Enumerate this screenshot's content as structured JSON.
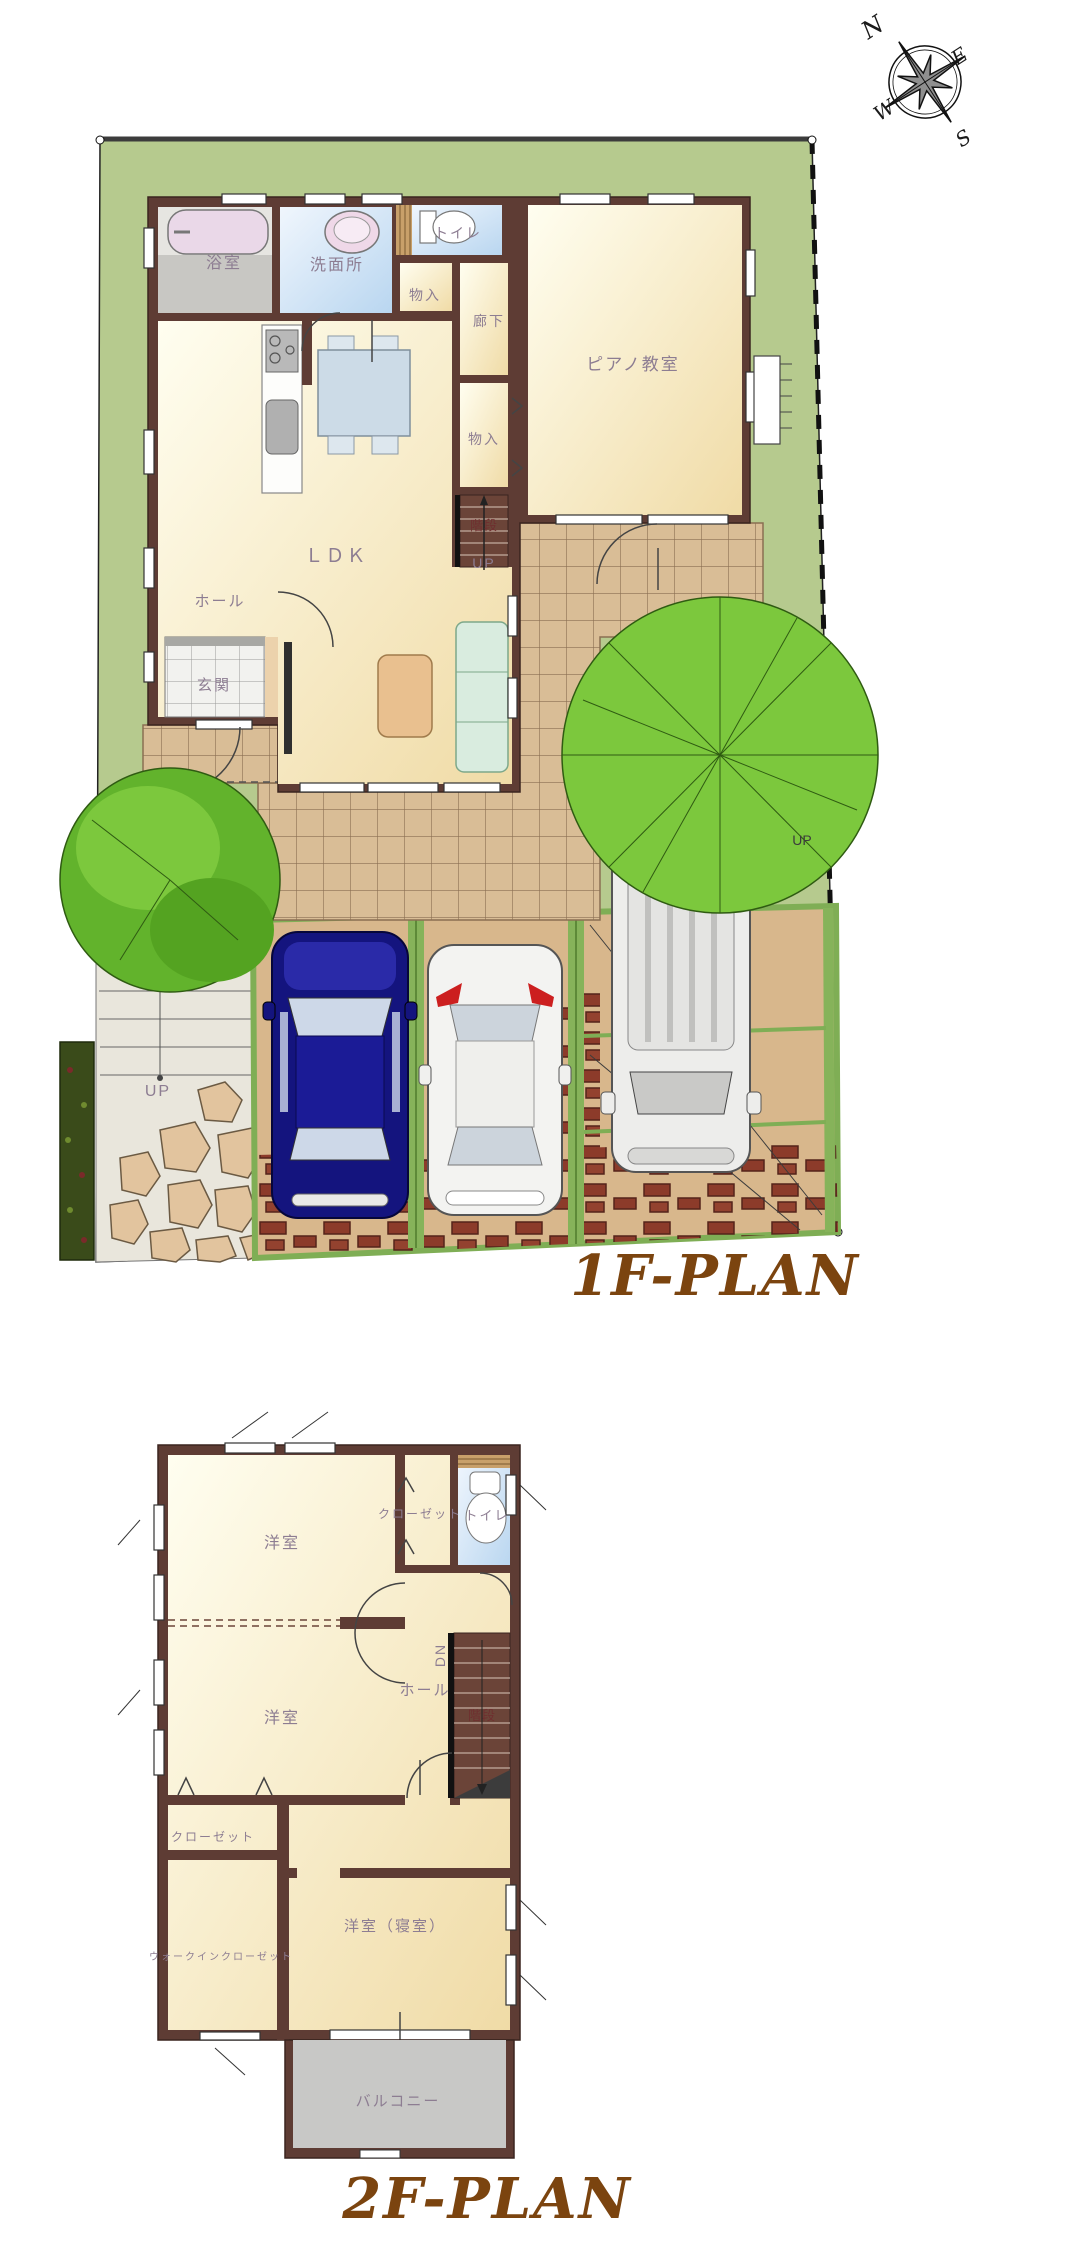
{
  "document": {
    "type": "floor-plan",
    "background": "#ffffff"
  },
  "compass": {
    "north": "N",
    "east": "E",
    "south": "S",
    "west": "W"
  },
  "plan1f": {
    "title": "1F-PLAN",
    "rooms": {
      "bath": "浴室",
      "washroom": "洗面所",
      "toilet": "トイレ",
      "storage_upper": "物入",
      "corridor": "廊下",
      "piano_room": "ピアノ教室",
      "storage_mid": "物入",
      "stairs": "階段",
      "stairs_up": "UP",
      "ldk": "ＬＤＫ",
      "hall": "ホール",
      "entrance": "玄関",
      "approach_up": "UP",
      "side_up": "UP"
    }
  },
  "plan2f": {
    "title": "2F-PLAN",
    "rooms": {
      "west_room_1": "洋室",
      "closet_top": "クローゼット",
      "toilet": "トイレ",
      "stairs_dn": "DN",
      "hall": "ホール",
      "stairs": "階段",
      "west_room_2": "洋室",
      "closet_left": "クローゼット",
      "walkin_closet": "ウォークインクローゼット",
      "bedroom": "洋室（寝室）",
      "balcony": "バルコニー"
    }
  },
  "colors": {
    "site_green": "#b6ca8e",
    "lawn_light": "#c1d49c",
    "tree_bright": "#7cc83d",
    "tree_dark": "#5aa526",
    "wall_brown": "#5e3c34",
    "floor_cream": "#f8ecc8",
    "floor_blue": "#cfe2f6",
    "tile_tan": "#d9bd96",
    "parking_tan": "#d8b78c",
    "brick_red": "#8c3b2a",
    "divider_green": "#86b35a",
    "driveway_gray": "#e9e6dc",
    "balcony_gray": "#c8c8c6",
    "car_blue": "#14147e",
    "car_white": "#f3f3f1",
    "label_purple": "#8d7d92",
    "label_dark_red": "#6f2f2f",
    "title_brown": "#7b440f"
  }
}
